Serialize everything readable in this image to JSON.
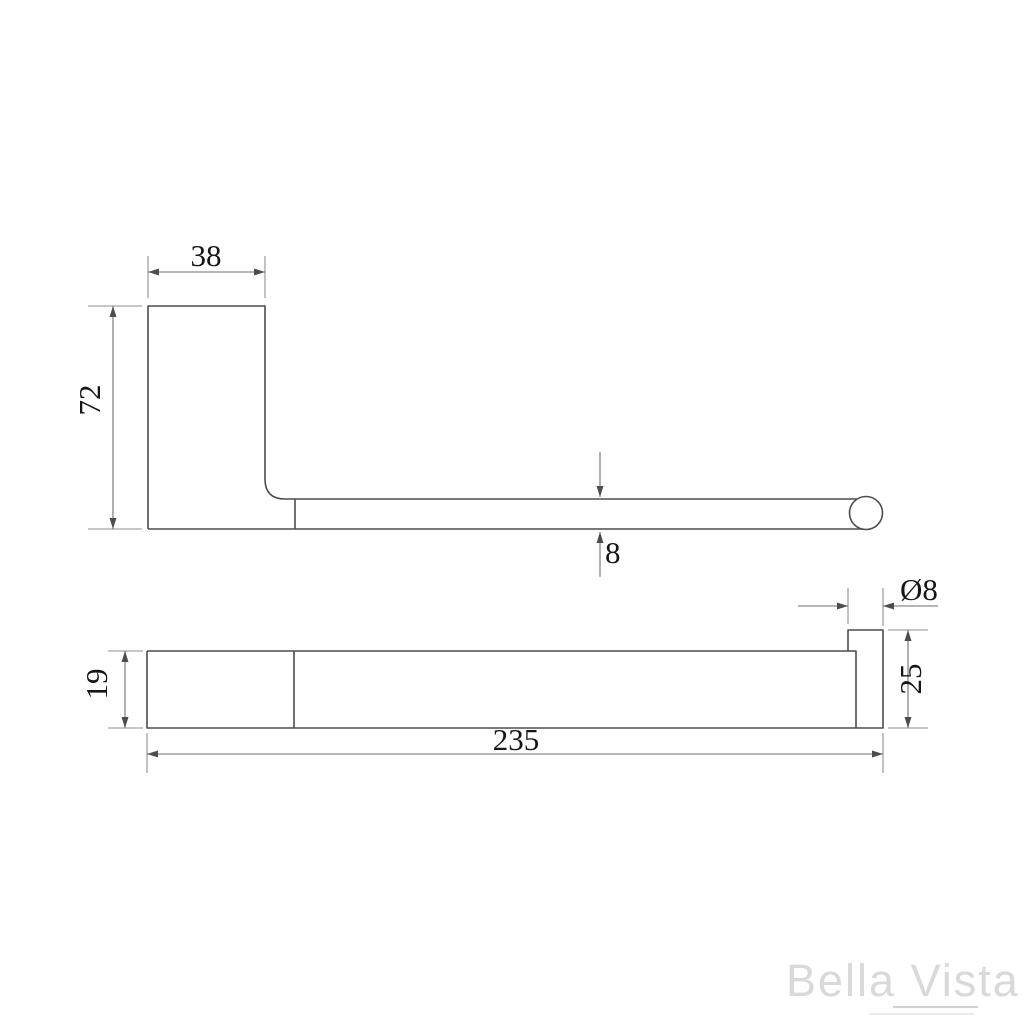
{
  "drawing": {
    "side_view": {
      "plate_width": "38",
      "plate_height": "72",
      "rail_thickness": "8"
    },
    "plan_view": {
      "body_depth": "19",
      "overall_length": "235",
      "rod_diameter": "Ø8",
      "end_cap_length": "25"
    }
  },
  "watermark": {
    "brand": "Bella Vista"
  },
  "colors": {
    "object_line": "#4d4d4d",
    "dimension_line": "#8f8f8f",
    "text": "#161616",
    "watermark": "#d9d9d9",
    "background": "#ffffff"
  }
}
